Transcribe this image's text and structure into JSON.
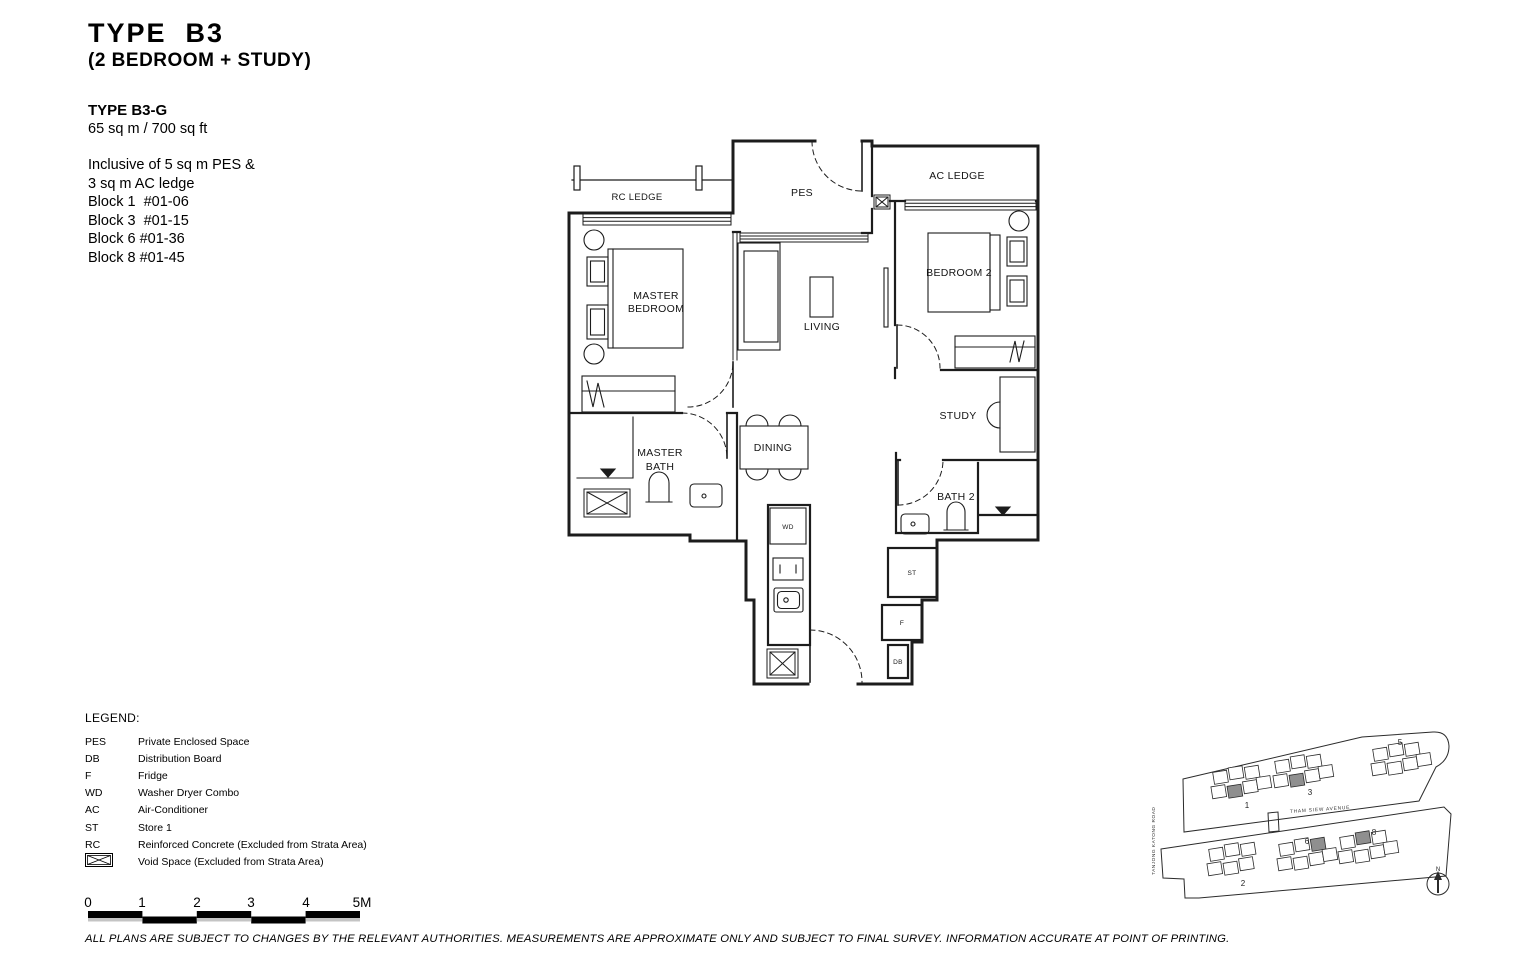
{
  "title": {
    "main": "TYPE  B3",
    "sub": "(2 BEDROOM + STUDY)"
  },
  "unit_info": {
    "type_name": "TYPE B3-G",
    "area": "65 sq m / 700 sq ft",
    "inclusive": [
      "Inclusive of 5 sq m PES &",
      "3 sq m AC ledge"
    ],
    "blocks": [
      "Block 1  #01-06",
      "Block 3  #01-15",
      "Block 6 #01-36",
      "Block 8 #01-45"
    ]
  },
  "floorplan": {
    "labels": {
      "rc_ledge": "RC LEDGE",
      "pes": "PES",
      "ac_ledge": "AC LEDGE",
      "master_bedroom_1": "MASTER",
      "master_bedroom_2": "BEDROOM",
      "living": "LIVING",
      "bedroom2": "BEDROOM 2",
      "study": "STUDY",
      "dining": "DINING",
      "master_bath_1": "MASTER",
      "master_bath_2": "BATH",
      "bath2": "BATH 2",
      "wd": "WD",
      "st": "ST",
      "f": "F",
      "db": "DB"
    }
  },
  "legend": {
    "heading": "LEGEND:",
    "items": [
      {
        "key": "PES",
        "desc": "Private Enclosed Space"
      },
      {
        "key": "DB",
        "desc": "Distribution Board"
      },
      {
        "key": "F",
        "desc": "Fridge"
      },
      {
        "key": "WD",
        "desc": "Washer Dryer Combo"
      },
      {
        "key": "AC",
        "desc": "Air-Conditioner"
      },
      {
        "key": "ST",
        "desc": "Store 1"
      },
      {
        "key": "RC",
        "desc": "Reinforced Concrete (Excluded from Strata Area)"
      }
    ],
    "void_item": {
      "desc": "Void Space (Excluded from Strata Area)"
    }
  },
  "scalebar": {
    "labels": [
      "0",
      "1",
      "2",
      "3",
      "4",
      "5M"
    ]
  },
  "siteplan": {
    "road_vertical": "TANJONG  KATONG  ROAD",
    "road_horizontal": "THAM   SIEW   AVENUE",
    "north_label": "N",
    "block_labels": {
      "b1": "1",
      "b3": "3",
      "b5": "5",
      "b2": "2",
      "b6": "6",
      "b8": "8"
    }
  },
  "disclaimer": "ALL PLANS ARE SUBJECT TO CHANGES BY THE RELEVANT AUTHORITIES. MEASUREMENTS ARE APPROXIMATE ONLY AND SUBJECT TO FINAL SURVEY. INFORMATION ACCURATE AT POINT OF PRINTING.",
  "colors": {
    "line": "#1c1c1c",
    "shaded_unit": "#8f8f8f"
  }
}
